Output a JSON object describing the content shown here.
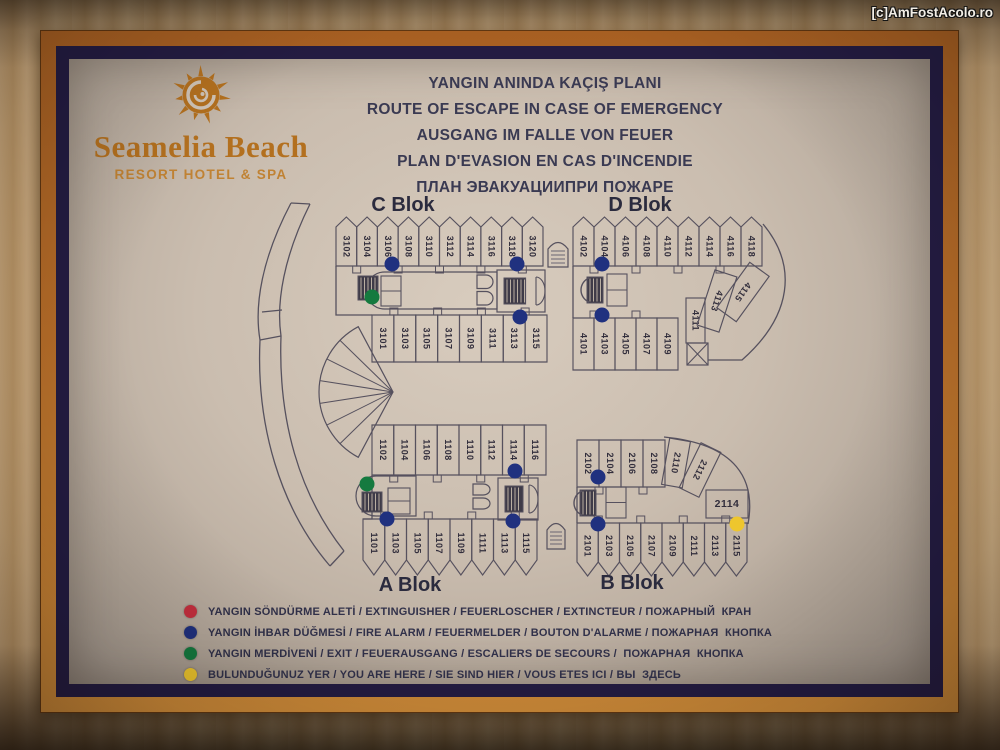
{
  "watermark": "[c]AmFostAcolo.ro",
  "logo": {
    "title": "Seamelia Beach",
    "subtitle": "RESORT HOTEL & SPA",
    "color": "#b3701f"
  },
  "titles": [
    "YANGIN ANINDA KAÇIŞ PLANI",
    "ROUTE OF ESCAPE IN CASE OF EMERGENCY",
    "AUSGANG IM FALLE VON FEUER",
    "PLAN D'EVASION EN CAS D'INCENDIE",
    "ПЛАН ЭВАКУАЦИИПРИ ПОЖАРЕ"
  ],
  "legend": [
    {
      "color": "#c62f3e",
      "symbol": "extinguisher-dot",
      "label": "YANGIN SÖNDÜRME ALETİ / EXTINGUISHER / FEUERLOSCHER / EXTINCTEUR / ПОЖАРНЫЙ  КРАН"
    },
    {
      "color": "#20317f",
      "symbol": "fire-alarm-dot",
      "label": "YANGIN İHBAR DÜĞMESİ / FIRE ALARM / FEUERMELDER / BOUTON D'ALARME / ПОЖАРНАЯ  КНОПКА"
    },
    {
      "color": "#157a3f",
      "symbol": "exit-dot",
      "label": "YANGIN MERDİVENİ / EXIT / FEUERAUSGANG / ESCALIERS DE SECOURS /  ПОЖАРНАЯ  КНОПКА"
    },
    {
      "color": "#eec62d",
      "symbol": "you-are-here-dot",
      "label": "BULUNDUĞUNUZ YER / YOU ARE HERE / SIE SIND HIER / VOUS ETES ICI / ВЫ  ЗДЕСЬ"
    }
  ],
  "plan": {
    "stroke": "#56515e",
    "room_text_color": "#322e3c",
    "label_color": "#2b2b3e",
    "dot_colors": {
      "blue": "#20317f",
      "green": "#157a3f",
      "yellow": "#eec62d",
      "red": "#c62f3e"
    },
    "block_labels": [
      {
        "text": "C Blok",
        "x": 403,
        "y": 211
      },
      {
        "text": "D Blok",
        "x": 640,
        "y": 211
      },
      {
        "text": "A Blok",
        "x": 410,
        "y": 591
      },
      {
        "text": "B Blok",
        "x": 632,
        "y": 589
      }
    ],
    "rows": [
      {
        "name": "C-top",
        "shape": "peakUp",
        "x": 336,
        "y": 227,
        "w": 207,
        "h": 39,
        "peak": 10,
        "notch": "bottom",
        "rooms": [
          "3102",
          "3104",
          "3106",
          "3108",
          "3110",
          "3112",
          "3114",
          "3116",
          "3118",
          "3120"
        ]
      },
      {
        "name": "C-bottom",
        "shape": "rect",
        "x": 372,
        "y": 315,
        "w": 175,
        "h": 47,
        "notch": "top",
        "rooms": [
          "3101",
          "3103",
          "3105",
          "3107",
          "3109",
          "3111",
          "3113",
          "3115"
        ]
      },
      {
        "name": "D-top",
        "shape": "peakUp",
        "x": 573,
        "y": 227,
        "w": 189,
        "h": 39,
        "peak": 10,
        "notch": "bottom",
        "rooms": [
          "4102",
          "4104",
          "4106",
          "4108",
          "4110",
          "4112",
          "4114",
          "4116",
          "4118"
        ]
      },
      {
        "name": "D-bottom",
        "shape": "rect",
        "x": 573,
        "y": 318,
        "w": 105,
        "h": 52,
        "notch": "top",
        "rooms": [
          "4101",
          "4103",
          "4105",
          "4107",
          "4109"
        ]
      },
      {
        "name": "A-top",
        "shape": "rect",
        "x": 372,
        "y": 425,
        "w": 174,
        "h": 50,
        "notch": "bottom",
        "rooms": [
          "1102",
          "1104",
          "1106",
          "1108",
          "1110",
          "1112",
          "1114",
          "1116"
        ]
      },
      {
        "name": "A-bottom",
        "shape": "peakDown",
        "x": 363,
        "y": 519,
        "w": 174,
        "h": 41,
        "peak": 15,
        "notch": "top",
        "rooms": [
          "1101",
          "1103",
          "1105",
          "1107",
          "1109",
          "1111",
          "1113",
          "1115"
        ]
      },
      {
        "name": "B-top",
        "shape": "rect",
        "x": 577,
        "y": 440,
        "w": 88,
        "h": 47,
        "notch": "bottom",
        "rooms": [
          "2102",
          "2104",
          "2106",
          "2108"
        ]
      },
      {
        "name": "B-bottom",
        "shape": "peakDown",
        "x": 577,
        "y": 523,
        "w": 170,
        "h": 39,
        "peak": 14,
        "notch": "top",
        "rooms": [
          "2101",
          "2103",
          "2105",
          "2107",
          "2109",
          "2111",
          "2113",
          "2115"
        ]
      }
    ],
    "special_rooms": [
      {
        "num": "4111",
        "cx": 695.5,
        "cy": 320.5,
        "w": 19,
        "h": 45,
        "angle": 0
      },
      {
        "num": "4113",
        "cx": 717,
        "cy": 301,
        "w": 23,
        "h": 58,
        "angle": 18
      },
      {
        "num": "4115",
        "cx": 743,
        "cy": 292,
        "w": 24,
        "h": 56,
        "angle": 36
      },
      {
        "num": "2110",
        "cx": 676,
        "cy": 463,
        "w": 21,
        "h": 47,
        "angle": 10
      },
      {
        "num": "2112",
        "cx": 700,
        "cy": 470,
        "w": 22,
        "h": 50,
        "angle": 26
      },
      {
        "num": "2114",
        "cx": 727,
        "cy": 504,
        "w": 42,
        "h": 28,
        "angle": 0,
        "horizontal": true
      }
    ],
    "outlines": [
      "M291,203 C262,258 254,305 260,340 C256,425 280,508 330,566",
      "M310,204 C284,256 276,302 281,336 C278,420 299,494 344,551",
      "M291,203 L310,204",
      "M330,566 L344,551",
      "M260,340 L281,336",
      "M262,312 L282,310",
      "M336,266 L336,315 L372,315",
      "M372,475 L372,519 L363,519",
      "M573,266 L573,318",
      "M577,487 L577,523",
      "M763,224 C798,266 792,316 742,360 L708,360",
      "M664,437 C737,444 756,480 748,524"
    ],
    "icons": [
      {
        "type": "stadium",
        "x": 366,
        "y": 272,
        "w": 131,
        "h": 37
      },
      {
        "type": "stairs",
        "x": 358,
        "y": 276,
        "w": 20,
        "h": 24
      },
      {
        "type": "cell2",
        "x": 381,
        "y": 276,
        "w": 20,
        "h": 30
      },
      {
        "type": "lift2",
        "x": 477,
        "y": 275,
        "w": 16,
        "h": 31
      },
      {
        "type": "core",
        "x": 497,
        "y": 270,
        "w": 48,
        "h": 42
      },
      {
        "type": "arch",
        "x": 548,
        "y": 240,
        "w": 20,
        "h": 27
      },
      {
        "type": "spiral",
        "x": 577,
        "y": 275,
        "w": 26,
        "h": 30
      },
      {
        "type": "cell2",
        "x": 607,
        "y": 274,
        "w": 20,
        "h": 32
      },
      {
        "type": "xbox",
        "x": 687,
        "y": 343,
        "w": 21,
        "h": 22
      },
      {
        "type": "stadium",
        "x": 356,
        "y": 476,
        "w": 60,
        "h": 40
      },
      {
        "type": "stairs",
        "x": 362,
        "y": 492,
        "w": 20,
        "h": 20
      },
      {
        "type": "cell2",
        "x": 388,
        "y": 488,
        "w": 22,
        "h": 26
      },
      {
        "type": "lift2",
        "x": 473,
        "y": 484,
        "w": 17,
        "h": 26
      },
      {
        "type": "core",
        "x": 498,
        "y": 478,
        "w": 40,
        "h": 42
      },
      {
        "type": "spiral",
        "x": 570,
        "y": 488,
        "w": 26,
        "h": 30
      },
      {
        "type": "cell2",
        "x": 606,
        "y": 487,
        "w": 20,
        "h": 31
      },
      {
        "type": "arch",
        "x": 547,
        "y": 521,
        "w": 18,
        "h": 28
      },
      {
        "type": "fan",
        "cx": 393,
        "cy": 392,
        "r": 74,
        "a1": 118,
        "a2": 242,
        "spokes": 6
      }
    ],
    "dots": [
      {
        "c": "blue",
        "x": 392,
        "y": 264
      },
      {
        "c": "blue",
        "x": 517,
        "y": 264
      },
      {
        "c": "blue",
        "x": 602,
        "y": 264
      },
      {
        "c": "blue",
        "x": 520,
        "y": 317
      },
      {
        "c": "blue",
        "x": 602,
        "y": 315
      },
      {
        "c": "blue",
        "x": 515,
        "y": 471
      },
      {
        "c": "blue",
        "x": 598,
        "y": 477
      },
      {
        "c": "blue",
        "x": 387,
        "y": 519
      },
      {
        "c": "blue",
        "x": 513,
        "y": 521
      },
      {
        "c": "blue",
        "x": 598,
        "y": 524
      },
      {
        "c": "green",
        "x": 372,
        "y": 297
      },
      {
        "c": "green",
        "x": 367,
        "y": 484
      },
      {
        "c": "yellow",
        "x": 737,
        "y": 524
      }
    ]
  }
}
